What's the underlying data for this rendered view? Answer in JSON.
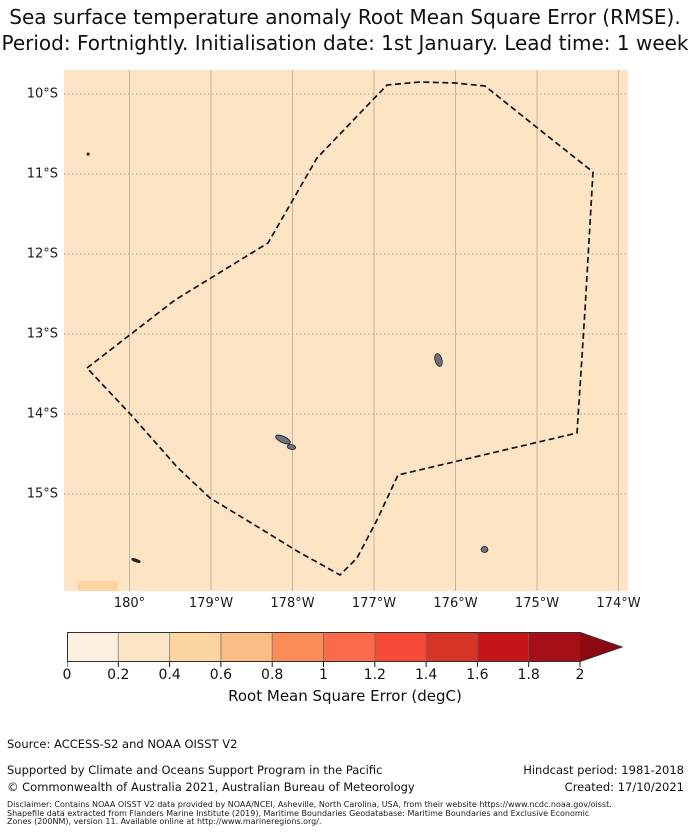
{
  "title": {
    "line1": "Sea surface temperature anomaly Root Mean Square Error (RMSE).",
    "line2": "Period: Fortnightly. Initialisation date: 1st January. Lead time: 1 week"
  },
  "axes": {
    "x_ticks": [
      "180°",
      "179°W",
      "178°W",
      "177°W",
      "176°W",
      "175°W",
      "174°W"
    ],
    "y_ticks": [
      "10°S",
      "11°S",
      "12°S",
      "13°S",
      "14°S",
      "15°S"
    ]
  },
  "colorbar": {
    "label": "Root Mean Square Error (degC)",
    "tick_labels": [
      "0",
      "0.2",
      "0.4",
      "0.6",
      "0.8",
      "1",
      "1.2",
      "1.4",
      "1.6",
      "1.8",
      "2"
    ],
    "segment_colors": [
      "#fdf0e0",
      "#fde6c8",
      "#fdd5a0",
      "#fbbd85",
      "#fb8d59",
      "#fb6b4b",
      "#f74b37",
      "#d63425",
      "#c5161b",
      "#a50f15"
    ],
    "arrow_color": "#8b0a10",
    "extend": "max"
  },
  "map": {
    "ocean_color": "#fce4c5",
    "hot_patch_color": "#fdd3a0",
    "gridline_color_v": "#bfb29a",
    "gridline_color_h": "#b3a793",
    "boundary_color": "#141414",
    "island_fill": "#6d717b",
    "island_edge": "#17171c"
  },
  "chart_data": {
    "type": "heatmap",
    "title": "Sea surface temperature anomaly Root Mean Square Error (RMSE). Period: Fortnightly. Initialisation date: 1st January. Lead time: 1 week",
    "x_tick_labels": [
      "180°",
      "179°W",
      "178°W",
      "177°W",
      "176°W",
      "175°W",
      "174°W"
    ],
    "y_tick_labels": [
      "10°S",
      "11°S",
      "12°S",
      "13°S",
      "14°S",
      "15°S"
    ],
    "colorbar_label": "Root Mean Square Error (degC)",
    "colorbar_ticks": [
      0,
      0.2,
      0.4,
      0.6,
      0.8,
      1,
      1.2,
      1.4,
      1.6,
      1.8,
      2
    ],
    "extend": "max",
    "field_summary": "RMSE is roughly uniform at about 0.2-0.4 degC over the mapped region, with one cell of 0.4-0.6 degC at the south-west corner; a dashed EEZ boundary polygon and several small islands are overlaid",
    "gridlines_x_px": [
      65.5,
      147,
      228.5,
      310,
      391.5,
      473,
      554.5
    ],
    "gridlines_y_px": [
      24,
      104,
      184,
      264,
      344,
      424
    ],
    "boundary_polygon_px": [
      [
        23,
        298
      ],
      [
        111,
        230
      ],
      [
        204,
        173
      ],
      [
        253,
        88
      ],
      [
        323,
        15
      ],
      [
        356,
        12
      ],
      [
        391,
        13
      ],
      [
        421,
        16
      ],
      [
        476,
        60
      ],
      [
        529,
        102
      ],
      [
        521,
        240
      ],
      [
        513,
        363
      ],
      [
        334,
        405
      ],
      [
        313,
        450
      ],
      [
        293,
        488
      ],
      [
        276,
        505
      ],
      [
        233,
        481
      ],
      [
        189,
        454
      ],
      [
        146,
        428
      ],
      [
        113,
        397
      ],
      [
        69,
        347
      ]
    ],
    "hot_patch_px": {
      "x": 14,
      "y": 511,
      "w": 40,
      "h": 10
    },
    "islands_px": [
      {
        "shape": "rect",
        "x": 23,
        "y": 83,
        "w": 2.2,
        "h": 2.2,
        "fill": "#2b2b30"
      },
      {
        "shape": "ellipse",
        "cx": 374.5,
        "cy": 290,
        "rx": 3.5,
        "ry": 6.5,
        "rot": -15
      },
      {
        "shape": "ellipse",
        "cx": 219,
        "cy": 369.5,
        "rx": 8,
        "ry": 3.2,
        "rot": 25
      },
      {
        "shape": "ellipse",
        "cx": 227.5,
        "cy": 377,
        "rx": 4.2,
        "ry": 2.4,
        "rot": 10
      },
      {
        "shape": "ellipse",
        "cx": 420.5,
        "cy": 479.5,
        "rx": 3.4,
        "ry": 3,
        "rot": 0
      },
      {
        "shape": "ellipse",
        "cx": 72,
        "cy": 490.5,
        "rx": 4.5,
        "ry": 1.3,
        "rot": 20,
        "fill": "#2b2b30"
      }
    ],
    "colorbar_geom": {
      "bar_width": 513,
      "bar_height": 30,
      "arrow_tip_x": 555
    }
  },
  "footer": {
    "source": "Source: ACCESS-S2 and NOAA OISST V2",
    "supported": "Supported by Climate and Oceans Support Program in the Pacific",
    "copyright": "© Commonwealth of Australia 2021, Australian Bureau of Meteorology",
    "hindcast": "Hindcast period: 1981-2018",
    "created": "Created: 17/10/2021",
    "disclaimer1": "Disclaimer: Contains NOAA OISST V2 data provided by NOAA/NCEI, Asheville, North Carolina, USA, from their website https://www.ncdc.noaa.gov/oisst.",
    "disclaimer2": "Shapefile data extracted from Flanders Marine Institute (2019), Maritime Boundaries Geodatabase: Maritime Boundaries and Exclusive Economic",
    "disclaimer3": "Zones (200NM), version 11. Available online at http://www.marineregions.org/."
  }
}
